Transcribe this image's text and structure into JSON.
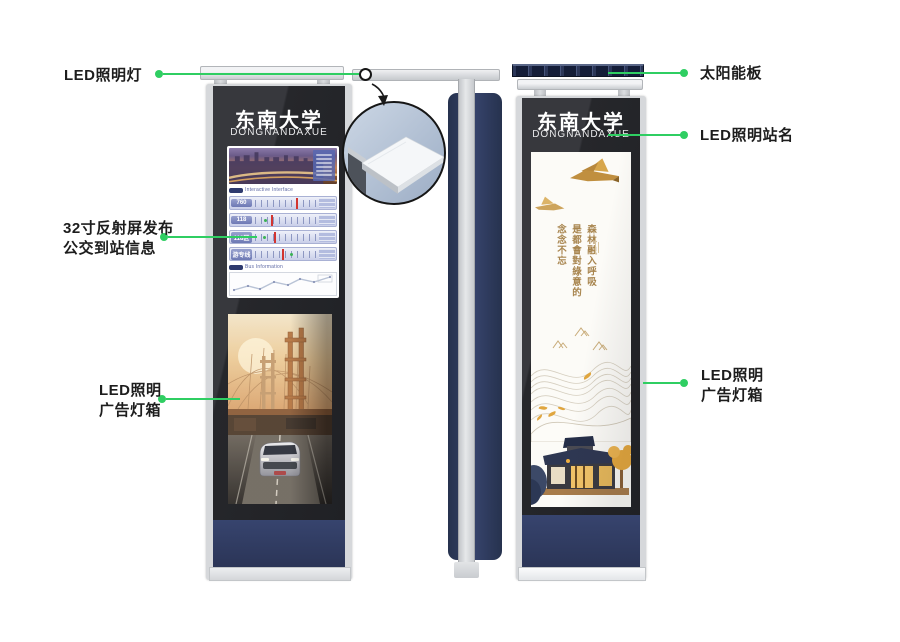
{
  "colors": {
    "accent_green": "#2fce62",
    "navy": "#2e3a5c",
    "dark_panel": "#26272b",
    "calligraphy_gold": "#a8854e"
  },
  "annotations": {
    "led_light": "LED照明灯",
    "solar": "太阳能板",
    "station_name": "LED照明站名",
    "screen_line1": "32寸反射屏发布",
    "screen_line2": "公交到站信息",
    "adbox_line1": "LED照明",
    "adbox_line2": "广告灯箱",
    "adbox_right_line1": "LED照明",
    "adbox_right_line2": "广告灯箱"
  },
  "left_pillar": {
    "name_cn": "东南大学",
    "name_en": "DONGNANDAXUE",
    "screen": {
      "section1": "Interactive Interface",
      "section2": "Bus Information",
      "routes": [
        {
          "number": "760"
        },
        {
          "number": "118"
        },
        {
          "number": "118区"
        },
        {
          "number": "游专线"
        }
      ]
    }
  },
  "right_pillar": {
    "name_cn": "东南大学",
    "name_en": "DONGNANDAXUE",
    "poster": {
      "calligraphy": [
        "森林融入呼吸",
        "是都會對綠意的",
        "念念不忘"
      ]
    }
  }
}
